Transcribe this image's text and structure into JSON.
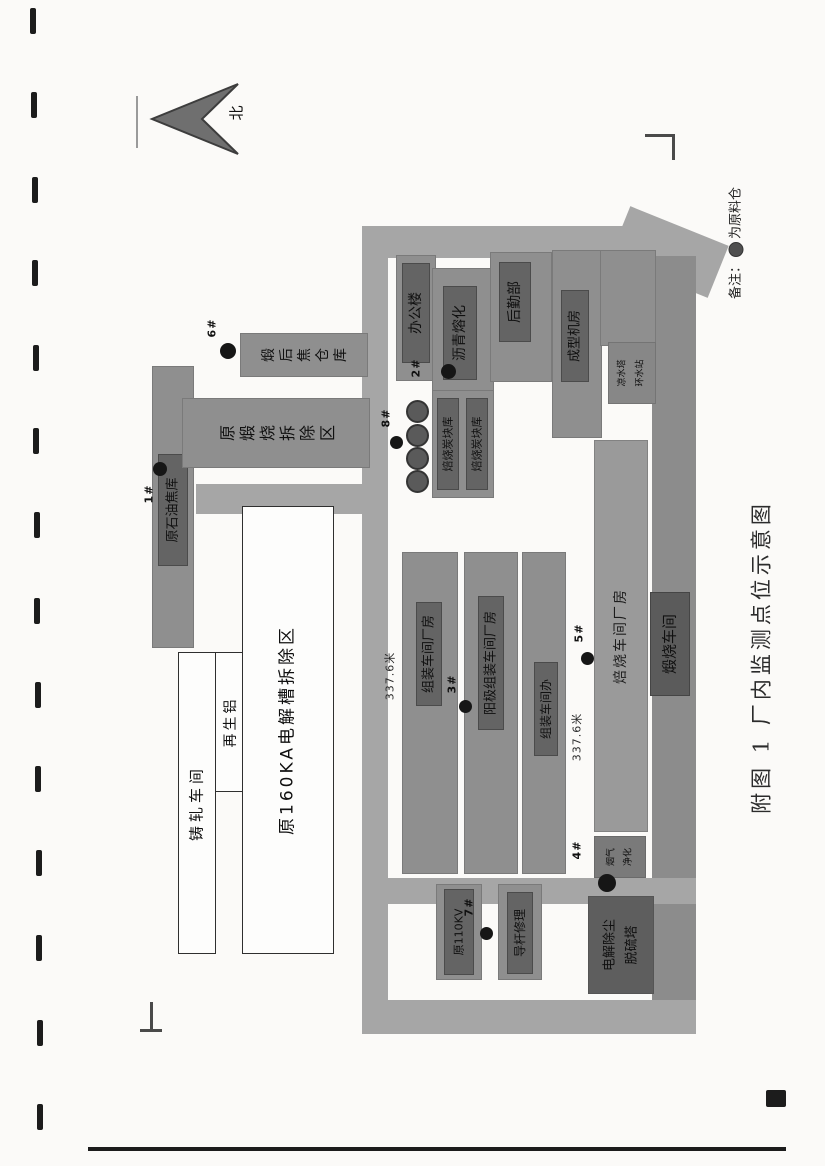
{
  "page": {
    "caption": "附图 1  厂内监测点位示意图"
  },
  "compass": {
    "label": "北"
  },
  "legend": {
    "prefix": "备注：",
    "suffix": "为原料仓"
  },
  "dimensions": {
    "left_road": "337.6米",
    "right_road": "337.6米"
  },
  "buildings": {
    "raw_coke_store": {
      "label": "原石油焦库"
    },
    "calcined_coke_store": {
      "label": "煅后焦仓库"
    },
    "former_calcining_area": {
      "label": "原煅烧拆除区"
    },
    "casting_rolling": {
      "label": "铸轧车间"
    },
    "recycled_aluminum": {
      "label": "再生铝"
    },
    "former_potline_area": {
      "label": "原160KA电解槽拆除区"
    },
    "office": {
      "label": "办公楼"
    },
    "pitch_melting": {
      "label": "沥青熔化"
    },
    "logistics": {
      "label": "后勤部"
    },
    "forming_room": {
      "label": "成型机房"
    },
    "cooling_station": {
      "line1": "凉水塔",
      "line2": "环水站"
    },
    "baked_block_store_a": {
      "label": "焙烧炭块库"
    },
    "baked_block_store_b": {
      "label": "焙烧炭块库"
    },
    "rodding_workshop": {
      "label": "组装车间厂房"
    },
    "anode_rodding_workshop": {
      "label": "阳极组装车间厂房"
    },
    "rodding_office": {
      "label": "组装车间办"
    },
    "baking_workshop": {
      "label": "焙烧车间厂房"
    },
    "calcining_workshop": {
      "label": "煅烧车间"
    },
    "flue_gas_purification": {
      "line1": "烟气",
      "line2": "净化"
    },
    "desulfurization": {
      "line1": "电解除尘",
      "line2": "脱硫塔"
    },
    "substation_110kv": {
      "label": "原110KV"
    },
    "rod_repair": {
      "label": "导杆修理"
    }
  },
  "monitoring_points": {
    "p1": {
      "label": "1#"
    },
    "p2": {
      "label": "2#"
    },
    "p3": {
      "label": "3#"
    },
    "p4": {
      "label": "4#"
    },
    "p5": {
      "label": "5#"
    },
    "p6": {
      "label": "6#"
    },
    "p7": {
      "label": "7#"
    },
    "p8": {
      "label": "8#"
    }
  }
}
